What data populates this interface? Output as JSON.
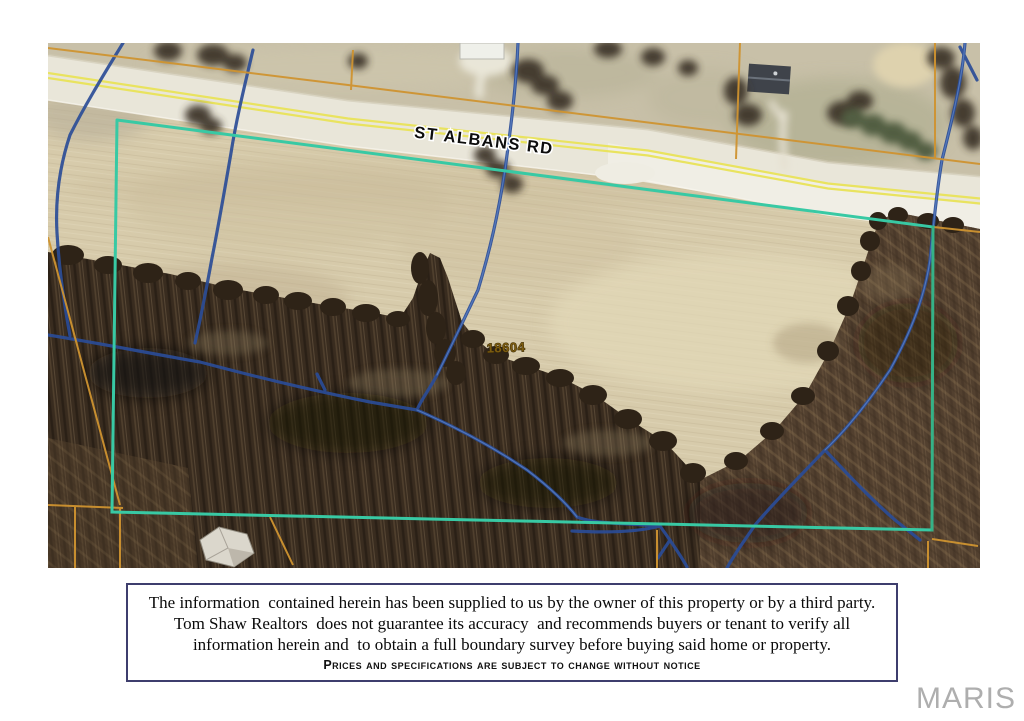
{
  "map": {
    "road_label": "ST ALBANS RD",
    "parcel_number": "18604",
    "colors": {
      "boundary_cyan": "#38c9a4",
      "boundary_cyan_east": "#35b287",
      "lot_line_orange": "#cf9330",
      "creek_blue": "#2b4d97",
      "creek_highlight": "#5b82c4",
      "road_yellow": "#e9e35f"
    }
  },
  "disclaimer": {
    "line1": "The information  contained herein has been supplied to us by the owner of this property or by a third party.",
    "line2": "Tom Shaw Realtors  does not guarantee its accuracy  and recommends buyers or tenant to verify all",
    "line3": "information herein and  to obtain a full boundary survey before buying said home or property.",
    "line4": "Prices and specifications are subject to change without notice"
  },
  "watermark": "MARIS"
}
